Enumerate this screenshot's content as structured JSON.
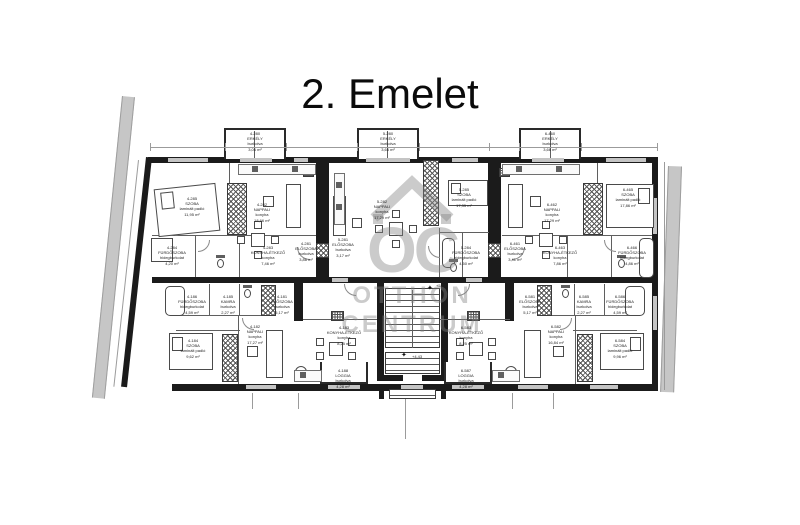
{
  "title": "2. Emelet",
  "watermark": {
    "logo_text": "OC",
    "line1": "OTTHON",
    "line2": "CENTRUM"
  },
  "levels": [
    {
      "value": "+5,87",
      "icon": "✦",
      "x": 436,
      "y": 283
    },
    {
      "value": "+4,43",
      "icon": "✦",
      "x": 412,
      "y": 354
    }
  ],
  "apartments": [
    {
      "id": "top-left",
      "rooms": [
        {
          "code": "4-280",
          "name": "ERKÉLY",
          "finish": "burkolva",
          "area": "3,06 m²",
          "x": 255,
          "y": 131
        },
        {
          "code": "4-285",
          "name": "SZOBA",
          "finish": "laminált padló",
          "area": "11,95 m²",
          "x": 192,
          "y": 196
        },
        {
          "code": "4-282",
          "name": "NAPPALI",
          "finish": "konyha",
          "area": "18,66 m²",
          "x": 262,
          "y": 202
        },
        {
          "code": "4-284",
          "name": "FÜRDŐSZOBA",
          "finish": "hidegburkolat",
          "area": "4,20 m²",
          "x": 172,
          "y": 245
        },
        {
          "code": "4-283",
          "name": "KONYHA-ÉTKEZŐ",
          "finish": "konyha",
          "area": "7,46 m²",
          "x": 268,
          "y": 245
        },
        {
          "code": "4-281",
          "name": "ELŐSZOBA",
          "finish": "burkolva",
          "area": "3,86 m²",
          "x": 306,
          "y": 241
        }
      ]
    },
    {
      "id": "top-middle",
      "rooms": [
        {
          "code": "5-280",
          "name": "ERKÉLY",
          "finish": "burkolva",
          "area": "3,66 m²",
          "x": 388,
          "y": 131
        },
        {
          "code": "5-282",
          "name": "NAPPALI",
          "finish": "konyha",
          "area": "17,29 m²",
          "x": 382,
          "y": 199
        },
        {
          "code": "5-285",
          "name": "SZOBA",
          "finish": "laminált padló",
          "area": "17,35 m²",
          "x": 464,
          "y": 187
        },
        {
          "code": "5-281",
          "name": "ELŐSZOBA",
          "finish": "burkolva",
          "area": "3,17 m²",
          "x": 343,
          "y": 237
        },
        {
          "code": "5-284",
          "name": "FÜRDŐSZOBA",
          "finish": "hidegburkolat",
          "area": "4,50 m²",
          "x": 466,
          "y": 245
        }
      ]
    },
    {
      "id": "top-right",
      "rooms": [
        {
          "code": "6-460",
          "name": "ERKÉLY",
          "finish": "burkolva",
          "area": "3,66 m²",
          "x": 550,
          "y": 131
        },
        {
          "code": "6-462",
          "name": "NAPPALI",
          "finish": "konyha",
          "area": "17,29 m²",
          "x": 552,
          "y": 202
        },
        {
          "code": "6-465",
          "name": "SZOBA",
          "finish": "laminált padló",
          "area": "17,86 m²",
          "x": 628,
          "y": 187
        },
        {
          "code": "6-461",
          "name": "ELŐSZOBA",
          "finish": "burkolva",
          "area": "3,41 m²",
          "x": 515,
          "y": 241
        },
        {
          "code": "6-463",
          "name": "KONYHA-ÉTKEZŐ",
          "finish": "konyha",
          "area": "7,86 m²",
          "x": 560,
          "y": 245
        },
        {
          "code": "6-466",
          "name": "FÜRDŐSZOBA",
          "finish": "hidegburkolat",
          "area": "4,86 m²",
          "x": 632,
          "y": 245
        }
      ]
    },
    {
      "id": "bottom-left",
      "rooms": [
        {
          "code": "4-186",
          "name": "FÜRDŐSZOBA",
          "finish": "hidegburkolat",
          "area": "4,59 m²",
          "x": 192,
          "y": 294
        },
        {
          "code": "4-185",
          "name": "KAMRA",
          "finish": "burkolva",
          "area": "2,27 m²",
          "x": 228,
          "y": 294
        },
        {
          "code": "4-181",
          "name": "ELŐSZOBA",
          "finish": "burkolva",
          "area": "5,17 m²",
          "x": 282,
          "y": 294
        },
        {
          "code": "4-184",
          "name": "SZOBA",
          "finish": "laminált padló",
          "area": "9,62 m²",
          "x": 193,
          "y": 338
        },
        {
          "code": "4-182",
          "name": "NAPPALI",
          "finish": "konyha",
          "area": "17,27 m²",
          "x": 255,
          "y": 324
        },
        {
          "code": "4-183",
          "name": "KONYHA-ÉTKEZŐ",
          "finish": "konyha",
          "area": "8,25 m²",
          "x": 344,
          "y": 325
        },
        {
          "code": "4-188",
          "name": "LOGGIA",
          "finish": "burkolva",
          "area": "4,28 m²",
          "x": 343,
          "y": 368
        }
      ]
    },
    {
      "id": "bottom-right",
      "rooms": [
        {
          "code": "6-586",
          "name": "FÜRDŐSZOBA",
          "finish": "hidegburkolat",
          "area": "4,59 m²",
          "x": 620,
          "y": 294
        },
        {
          "code": "6-585",
          "name": "KAMRA",
          "finish": "burkolva",
          "area": "2,27 m²",
          "x": 584,
          "y": 294
        },
        {
          "code": "6-581",
          "name": "ELŐSZOBA",
          "finish": "burkolva",
          "area": "5,17 m²",
          "x": 530,
          "y": 294
        },
        {
          "code": "6-584",
          "name": "SZOBA",
          "finish": "laminált padló",
          "area": "9,96 m²",
          "x": 620,
          "y": 338
        },
        {
          "code": "6-582",
          "name": "NAPPALI",
          "finish": "konyha",
          "area": "16,84 m²",
          "x": 556,
          "y": 324
        },
        {
          "code": "6-583",
          "name": "KONYHA-ÉTKEZŐ",
          "finish": "konyha",
          "area": "8,25 m²",
          "x": 466,
          "y": 325
        },
        {
          "code": "6-587",
          "name": "LOGGIA",
          "finish": "burkolva",
          "area": "4,28 m²",
          "x": 466,
          "y": 368
        }
      ]
    }
  ]
}
